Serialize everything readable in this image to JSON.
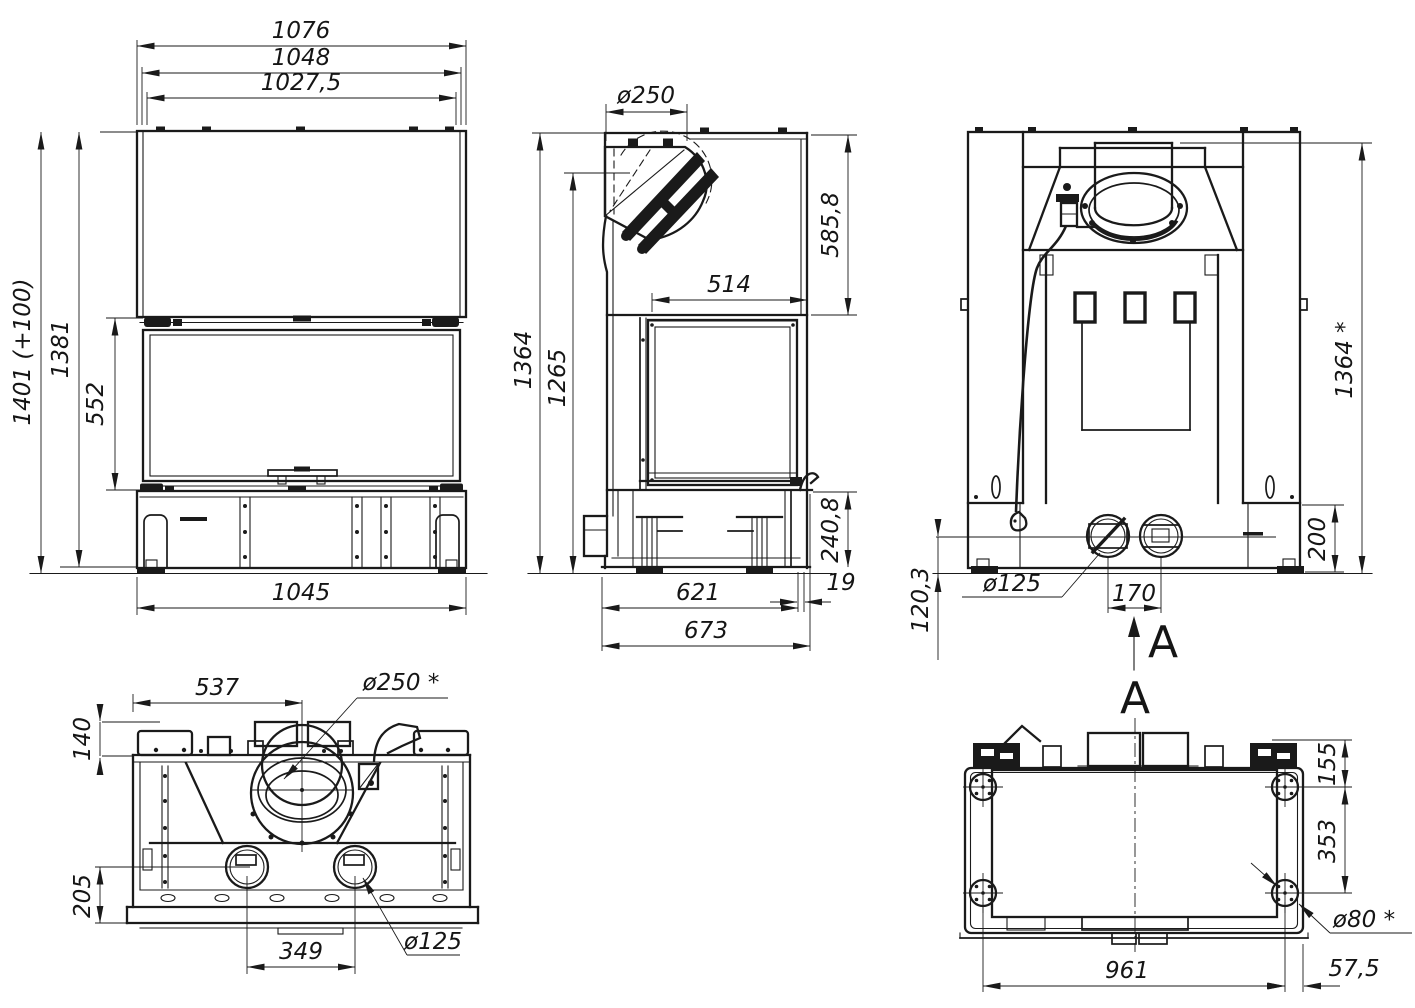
{
  "page": {
    "background": "#ffffff",
    "ink": "#1a1a1a",
    "sheet_name": "fireplace-insert-dimension-drawing"
  },
  "views": {
    "front": {
      "dims": {
        "overall_width": "1076",
        "casing_width": "1048",
        "opening_width": "1027,5",
        "total_height": "1401 (+100)",
        "body_height": "1381",
        "door_height": "552",
        "base_width": "1045"
      }
    },
    "side": {
      "dims": {
        "flue_diameter": "ø250",
        "hood_height": "585,8",
        "glass_depth": "514",
        "total_height": "1364",
        "front_height": "1265",
        "plinth_height": "240,8",
        "rear_lip": "19",
        "base_depth": "621",
        "overall_depth": "673"
      }
    },
    "rear": {
      "section_letter": "A",
      "dims": {
        "total_height": "1364 *",
        "plinth_height": "200",
        "intake_diameter": "ø125",
        "intake_spacing": "170",
        "intake_axis_height": "120,3"
      }
    },
    "top": {
      "dims": {
        "flue_center_offset": "537",
        "flue_diameter": "ø250 *",
        "rear_ledge": "140",
        "front_ledge": "205",
        "intake_spacing": "349",
        "intake_diameter": "ø125"
      }
    },
    "bottom": {
      "section_letter": "A",
      "dims": {
        "foot_front_offset": "155",
        "foot_depth_spacing": "353",
        "foot_diameter": "ø80 *",
        "foot_width_spacing": "961",
        "foot_side_offset": "57,5"
      }
    }
  }
}
